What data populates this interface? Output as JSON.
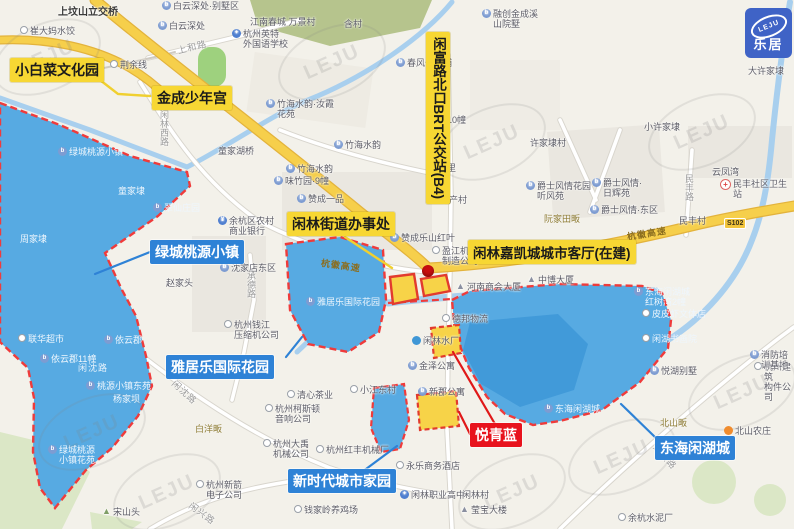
{
  "map": {
    "logo": {
      "en": "LEJU",
      "cn": "乐居"
    },
    "watermark": {
      "text": "LEJU",
      "positions": [
        {
          "x": 45,
          "y": 55
        },
        {
          "x": 330,
          "y": 60
        },
        {
          "x": 700,
          "y": 130
        },
        {
          "x": 490,
          "y": 140
        },
        {
          "x": 90,
          "y": 430
        },
        {
          "x": 165,
          "y": 490
        },
        {
          "x": 510,
          "y": 490
        },
        {
          "x": 620,
          "y": 455
        },
        {
          "x": 740,
          "y": 390
        }
      ]
    },
    "badge": {
      "text": "S102",
      "x": 724,
      "y": 218
    },
    "marker": {
      "x": 428,
      "y": 271
    },
    "callouts": [
      {
        "id": "xiaobaicai-culture-park",
        "type": "yellow",
        "text": "小白菜文化园",
        "x": 10,
        "y": 58,
        "size": 14
      },
      {
        "id": "jincheng-youth-palace",
        "type": "yellow",
        "text": "金成少年宫",
        "x": 152,
        "y": 86,
        "size": 14
      },
      {
        "id": "brt-station",
        "type": "yellow",
        "text": "闲富路北口BRT公交站(B4)",
        "x": 426,
        "y": 32,
        "size": 13.5,
        "vertical": true
      },
      {
        "id": "xianlin-subdistrict-office",
        "type": "yellow",
        "text": "闲林街道办事处",
        "x": 287,
        "y": 212,
        "size": 14
      },
      {
        "id": "jiakaicheng-city-hall",
        "type": "yellow",
        "text": "闲林嘉凯城城市客厅(在建)",
        "x": 468,
        "y": 240,
        "size": 13.5
      },
      {
        "id": "lvcheng-taoyuan-town",
        "type": "blue",
        "text": "绿城桃源小镇",
        "x": 150,
        "y": 240,
        "size": 14
      },
      {
        "id": "yajule-international-garden",
        "type": "blue",
        "text": "雅居乐国际花园",
        "x": 166,
        "y": 355,
        "size": 14
      },
      {
        "id": "new-era-city-home",
        "type": "blue",
        "text": "新时代城市家园",
        "x": 288,
        "y": 469,
        "size": 14
      },
      {
        "id": "donghai-xianhu-city",
        "type": "blue",
        "text": "东海闲湖城",
        "x": 655,
        "y": 436,
        "size": 14
      },
      {
        "id": "yueqinglan",
        "type": "red",
        "text": "悦青蓝",
        "x": 470,
        "y": 423,
        "size": 14
      }
    ],
    "icon_glyphs": {
      "bs": "b",
      "dot": "",
      "bank": "¥",
      "school": "✦",
      "hosp": "+",
      "bldg": "▲",
      "hill": "▲",
      "orange": "",
      "water": ""
    },
    "pois": [
      {
        "t": "崔大妈水饺",
        "x": 20,
        "y": 26,
        "icon": "dot"
      },
      {
        "t": "上坟山立交桥",
        "x": 58,
        "y": 8,
        "cls": "struct"
      },
      {
        "t": "白云深处·别墅区",
        "x": 162,
        "y": 1,
        "icon": "bs"
      },
      {
        "t": "白云深处",
        "x": 158,
        "y": 21,
        "icon": "bs"
      },
      {
        "t": "江南春城 万景村",
        "x": 250,
        "y": 17
      },
      {
        "t": "含村",
        "x": 344,
        "y": 19
      },
      {
        "t": "杭州英特\n外国语学校",
        "x": 232,
        "y": 29,
        "icon": "school"
      },
      {
        "t": "融创金成溪\n山院墅",
        "x": 482,
        "y": 9,
        "icon": "bs"
      },
      {
        "t": "春风长乐埔",
        "x": 396,
        "y": 58,
        "icon": "bs"
      },
      {
        "t": "荆余线",
        "x": 110,
        "y": 60,
        "icon": "dot"
      },
      {
        "t": "大许家埭",
        "x": 748,
        "y": 66
      },
      {
        "t": "小许家埭",
        "x": 644,
        "y": 122
      },
      {
        "t": "许家埭村",
        "x": 530,
        "y": 138
      },
      {
        "t": "云凤湾",
        "x": 712,
        "y": 167
      },
      {
        "t": "竹海水韵·汝霞\n花苑",
        "x": 266,
        "y": 99,
        "icon": "bs"
      },
      {
        "t": "竹海水韵",
        "x": 334,
        "y": 140,
        "icon": "bs"
      },
      {
        "t": "竹海水韵",
        "x": 286,
        "y": 164,
        "icon": "bs"
      },
      {
        "t": "10幢",
        "x": 447,
        "y": 115
      },
      {
        "t": "凤里",
        "x": 438,
        "y": 163
      },
      {
        "t": "水产村",
        "x": 440,
        "y": 195
      },
      {
        "t": "童家湖桥",
        "x": 218,
        "y": 146
      },
      {
        "t": "绿城桃源小镇",
        "x": 58,
        "y": 147,
        "icon": "bs",
        "cls": "onblue"
      },
      {
        "t": "童家埭",
        "x": 118,
        "y": 186,
        "cls": "onblue"
      },
      {
        "t": "周家埭",
        "x": 20,
        "y": 234,
        "cls": "onblue"
      },
      {
        "t": "翠仙庄园",
        "x": 153,
        "y": 203,
        "icon": "bs",
        "cls": "onblue"
      },
      {
        "t": "余杭区农村\n商业银行",
        "x": 218,
        "y": 216,
        "icon": "bank"
      },
      {
        "t": "沈家店东区",
        "x": 220,
        "y": 263,
        "icon": "bs"
      },
      {
        "t": "赵家头",
        "x": 166,
        "y": 278
      },
      {
        "t": "杭州钱江\n压缩机公司",
        "x": 224,
        "y": 320,
        "icon": "dot"
      },
      {
        "t": "联华超市",
        "x": 18,
        "y": 334,
        "icon": "dot",
        "cls": "onblue"
      },
      {
        "t": "依云郡",
        "x": 104,
        "y": 335,
        "icon": "bs",
        "cls": "onblue"
      },
      {
        "t": "依云郡11幢",
        "x": 40,
        "y": 354,
        "icon": "bs",
        "cls": "onblue"
      },
      {
        "t": "桃源小镇东苑",
        "x": 86,
        "y": 381,
        "icon": "bs",
        "cls": "onblue"
      },
      {
        "t": "杨家坝",
        "x": 113,
        "y": 394,
        "cls": "onblue"
      },
      {
        "t": "绿城桃源\n小镇花苑",
        "x": 48,
        "y": 445,
        "icon": "bs",
        "cls": "onblue"
      },
      {
        "t": "味竹园·9幢",
        "x": 274,
        "y": 176,
        "icon": "bs"
      },
      {
        "t": "赞成一品",
        "x": 297,
        "y": 194,
        "icon": "bs"
      },
      {
        "t": "赞成乐山红叶",
        "x": 390,
        "y": 233,
        "icon": "bs"
      },
      {
        "t": "盈江机械\n制造公司",
        "x": 432,
        "y": 246,
        "icon": "dot"
      },
      {
        "t": "河南商会大厦",
        "x": 456,
        "y": 282,
        "icon": "bldg"
      },
      {
        "t": "中博大厦",
        "x": 527,
        "y": 275,
        "icon": "bldg"
      },
      {
        "t": "德邦物流",
        "x": 442,
        "y": 314,
        "icon": "dot"
      },
      {
        "t": "闲林水厂",
        "x": 412,
        "y": 336,
        "icon": "water"
      },
      {
        "t": "金泽公寓",
        "x": 408,
        "y": 361,
        "icon": "bs"
      },
      {
        "t": "新郡公寓",
        "x": 418,
        "y": 387,
        "icon": "bs"
      },
      {
        "t": "小江东村",
        "x": 350,
        "y": 385,
        "icon": "dot"
      },
      {
        "t": "清心茶业",
        "x": 287,
        "y": 390,
        "icon": "dot"
      },
      {
        "t": "杭州柯斯顿\n音响公司",
        "x": 265,
        "y": 404,
        "icon": "dot"
      },
      {
        "t": "杭州大禹\n机械公司",
        "x": 263,
        "y": 439,
        "icon": "dot"
      },
      {
        "t": "杭州红丰机械厂",
        "x": 316,
        "y": 445,
        "icon": "dot"
      },
      {
        "t": "永乐商务酒店",
        "x": 396,
        "y": 461,
        "icon": "dot"
      },
      {
        "t": "闲林职业高中",
        "x": 400,
        "y": 490,
        "icon": "school"
      },
      {
        "t": "闲林村",
        "x": 462,
        "y": 490
      },
      {
        "t": "莹宝大楼",
        "x": 460,
        "y": 505,
        "icon": "bldg"
      },
      {
        "t": "钱家岭养鸡场",
        "x": 294,
        "y": 505,
        "icon": "dot"
      },
      {
        "t": "宋山头",
        "x": 102,
        "y": 507,
        "icon": "hill"
      },
      {
        "t": "杭州新箭\n电子公司",
        "x": 196,
        "y": 480,
        "icon": "dot"
      },
      {
        "t": "余杭水泥厂",
        "x": 618,
        "y": 513,
        "icon": "dot"
      },
      {
        "t": "杭州建筑\n构件公司",
        "x": 754,
        "y": 362,
        "icon": "dot"
      },
      {
        "t": "消防培训基地",
        "x": 750,
        "y": 350,
        "icon": "bs"
      },
      {
        "t": "悦湖别墅",
        "x": 650,
        "y": 366,
        "icon": "bs"
      },
      {
        "t": "北山农庄",
        "x": 724,
        "y": 426,
        "icon": "orange"
      },
      {
        "t": "东海闲湖城",
        "x": 544,
        "y": 404,
        "icon": "bs",
        "cls": "onblue"
      },
      {
        "t": "东海闲湖城\n红树湾2幢",
        "x": 634,
        "y": 287,
        "icon": "bs",
        "cls": "onblue"
      },
      {
        "t": "皮皮虾文体店",
        "x": 642,
        "y": 309,
        "icon": "dot",
        "cls": "onblue"
      },
      {
        "t": "闲湖书画院",
        "x": 642,
        "y": 334,
        "icon": "dot",
        "cls": "onblue"
      },
      {
        "t": "民丰社区卫生站",
        "x": 720,
        "y": 179,
        "icon": "hosp"
      },
      {
        "t": "民丰村",
        "x": 679,
        "y": 216
      },
      {
        "t": "爵士风情花园\n听风苑",
        "x": 526,
        "y": 181,
        "icon": "bs"
      },
      {
        "t": "爵士风情·\n日辉苑",
        "x": 592,
        "y": 178,
        "icon": "bs"
      },
      {
        "t": "爵士风情·东区",
        "x": 590,
        "y": 205,
        "icon": "bs"
      },
      {
        "t": "阮家田畈",
        "x": 544,
        "y": 214,
        "cls": "village"
      },
      {
        "t": "白洋畈",
        "x": 195,
        "y": 424,
        "cls": "village"
      },
      {
        "t": "北山畈",
        "x": 660,
        "y": 418,
        "cls": "village"
      },
      {
        "t": "雅居乐国际花园",
        "x": 306,
        "y": 297,
        "icon": "bs",
        "cls": "onblue"
      }
    ],
    "road_labels": [
      {
        "t": "闲林西路",
        "x": 158,
        "y": 110,
        "vert": true
      },
      {
        "t": "上和路",
        "x": 176,
        "y": 44,
        "rot": -14
      },
      {
        "t": "民丰路",
        "x": 683,
        "y": 174,
        "vert": true
      },
      {
        "t": "承德路",
        "x": 245,
        "y": 271,
        "vert": true
      },
      {
        "t": "闲沈路",
        "x": 78,
        "y": 361,
        "cls": "onblue"
      },
      {
        "t": "闲沈路",
        "x": 178,
        "y": 377,
        "rot": 42
      },
      {
        "t": "闲兴路",
        "x": 194,
        "y": 499,
        "rot": 36
      },
      {
        "t": "湖滨路",
        "x": 660,
        "y": 441,
        "rot": 48
      },
      {
        "t": "杭徽高速",
        "x": 322,
        "y": 256,
        "rot": 8,
        "cls": "hw"
      },
      {
        "t": "杭徽高速",
        "x": 626,
        "y": 230,
        "rot": -9,
        "cls": "hw"
      }
    ]
  }
}
